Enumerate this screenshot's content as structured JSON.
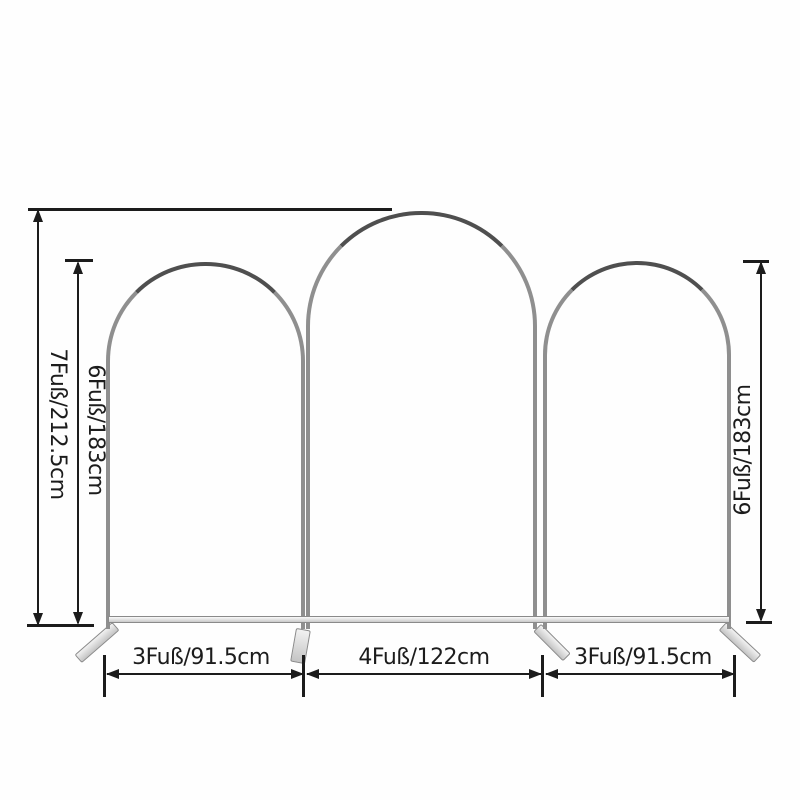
{
  "colors": {
    "background": "#fefefe",
    "ink": "#1c1c1c",
    "frame-dark": "#4f4f4f",
    "frame-mid": "#8f8f8f",
    "frame-edge": "#8a8a8a",
    "foot-hi": "#f2f2f2",
    "foot-lo": "#c4c4c4"
  },
  "dimensions": {
    "total_height": "7Fuß/212.5cm",
    "left_arch_height": "6Fuß/183cm",
    "right_arch_height": "6Fuß/183cm",
    "left_arch_width": "3Fuß/91.5cm",
    "middle_arch_width": "4Fuß/122cm",
    "right_arch_width": "3Fuß/91.5cm"
  }
}
